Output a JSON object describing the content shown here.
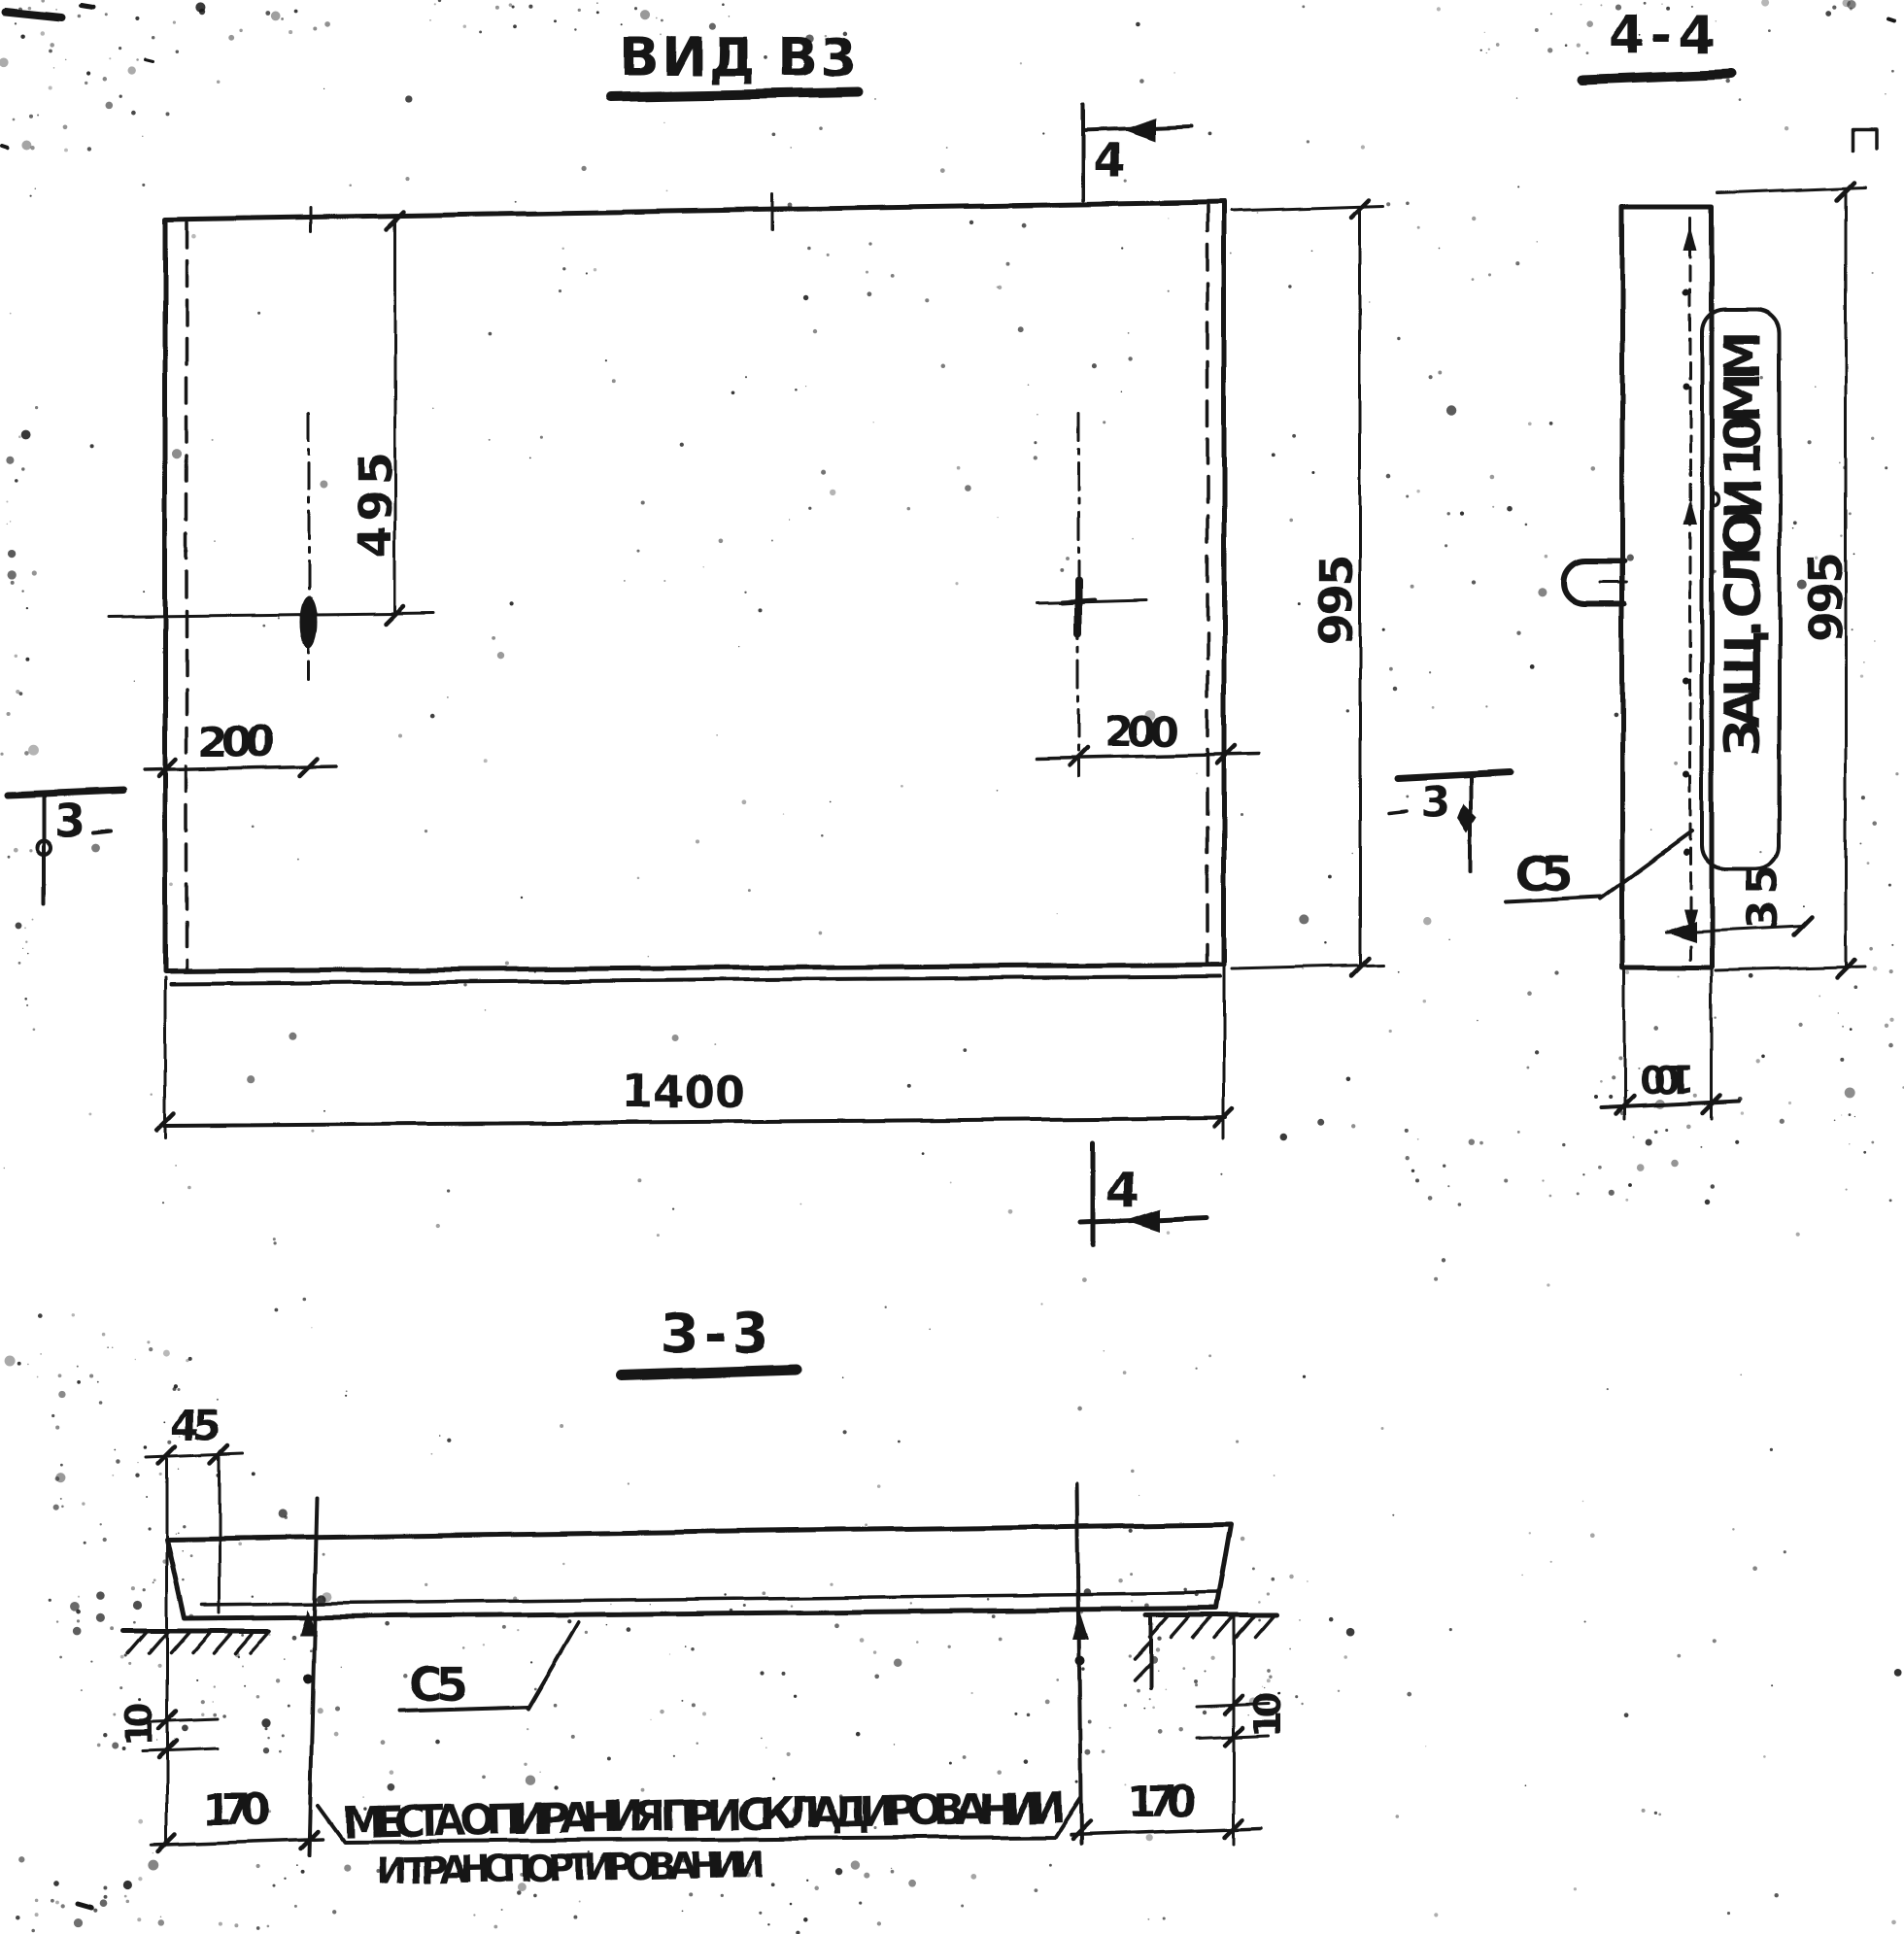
{
  "colors": {
    "ink": "#161616",
    "paper": "#ffffff"
  },
  "view_b3": {
    "title": "ВИД В3",
    "dim_495": "495",
    "dim_200_left": "200",
    "dim_200_right": "200",
    "dim_995": "995",
    "dim_1400": "1400",
    "marker_3": "3",
    "marker_4_top": "4",
    "marker_4_bottom": "4"
  },
  "section_4_4": {
    "title": "4-4",
    "note_protective_layer": "ЗАЩ. СЛОЙ 10ММ",
    "dim_995": "995",
    "dim_cover_35": "35",
    "dim_thickness_100": "100",
    "mesh_label": "С5",
    "marker_3": "3"
  },
  "section_3_3": {
    "title": "3-3",
    "dim_45": "45",
    "dim_10_left": "10",
    "dim_10_right": "10",
    "dim_170_left": "170",
    "dim_170_right": "170",
    "mesh_label": "С5",
    "note_line1": "МЕСТА ОПИРАНИЯ ПРИ СКЛАДИРОВАНИИ",
    "note_line2": "И ТРАНСПОРТИРОВАНИИ"
  }
}
